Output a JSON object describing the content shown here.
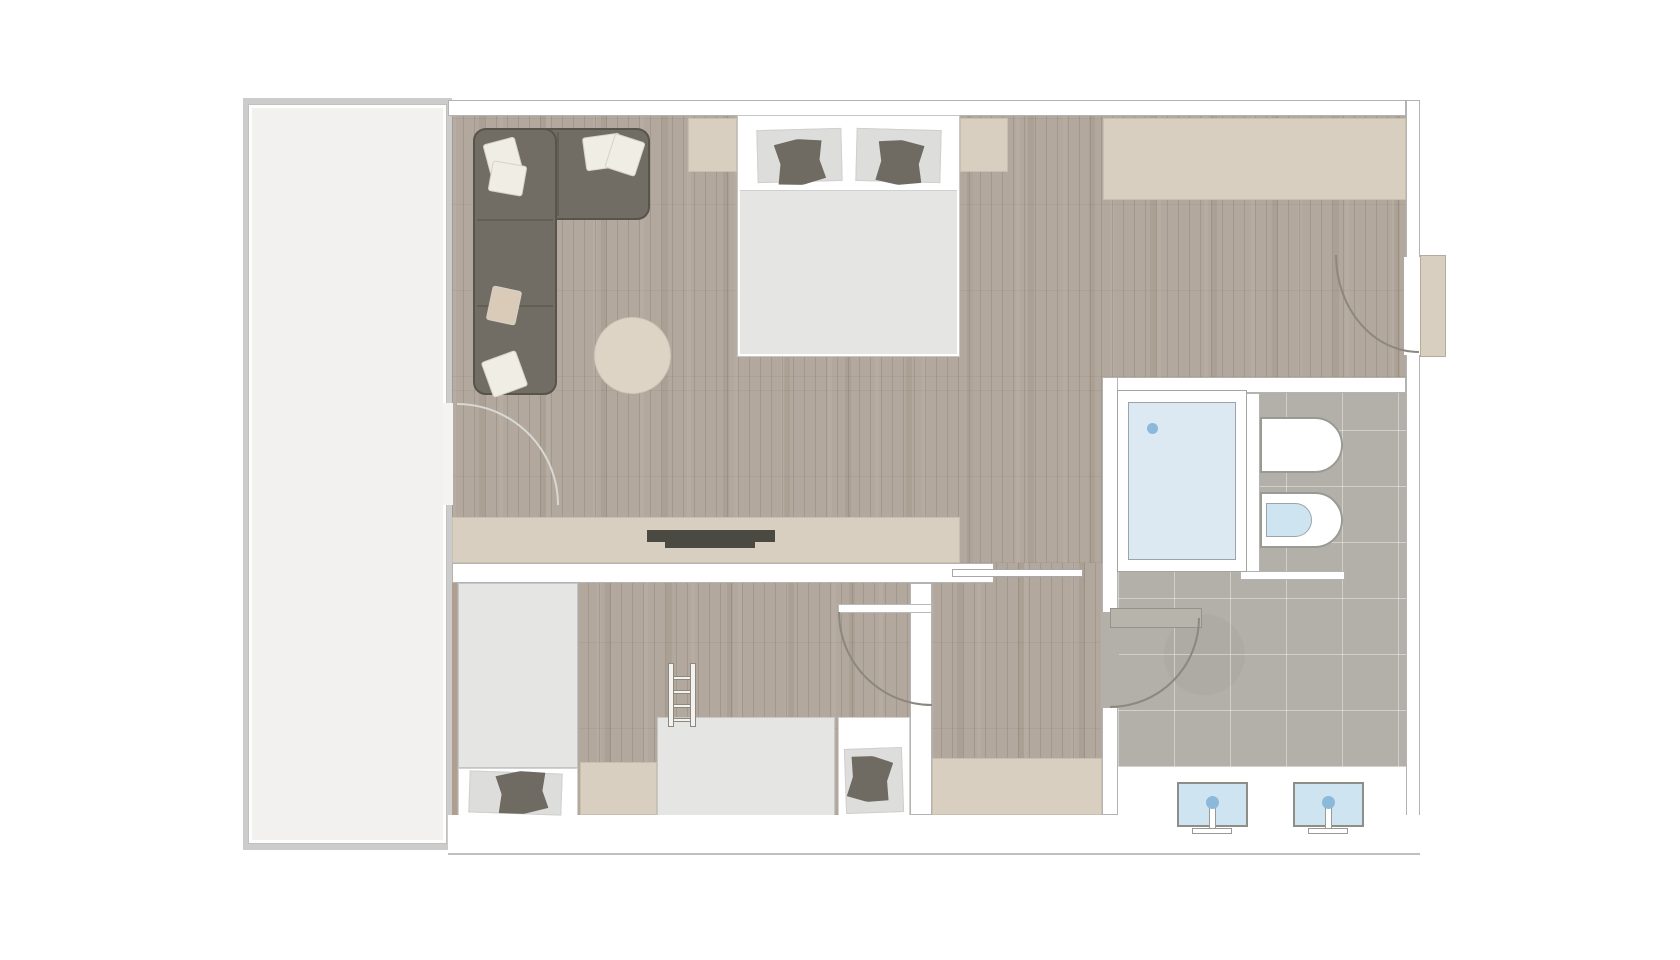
{
  "palette": {
    "background": "#ffffff",
    "wall_fill": "#ffffff",
    "wall_line": "#b3b3b3",
    "arc_line": "#8d887f",
    "arc_light": "#d8d8d4",
    "wood": "#b2a89d",
    "tile": "#b2b0a8",
    "balcony_band": "#cccccc",
    "balcony_floor": "#f2f1ef",
    "furniture_beige": "#d9cfc0",
    "furniture_beige_line": "#c9bfae",
    "sofa": "#716d65",
    "sofa_line": "#57544c",
    "cushion_dark": "#6f6b63",
    "pillow_light": "#dddddb",
    "pillow_white": "#f0ede5",
    "pillow_beige": "#d9cbb8",
    "duvet_gray": "#e5e5e3",
    "bed_white": "#ffffff",
    "ottoman": "#ded4c5",
    "tv_dark": "#4b4a42",
    "water_light": "#dce8f2",
    "water_mid": "#cfe4f1",
    "water_dot": "#8cb9da",
    "fixture_line": "#9a9a94",
    "door_leaf_gray": "#b7b4ab"
  },
  "floor_plan": {
    "type": "apartment-hotel-suite-top-view",
    "rooms": [
      {
        "id": "living-bedroom",
        "floor": "wood",
        "furniture": [
          "corner-sofa",
          "sofa-cushions",
          "ottoman",
          "double-bed",
          "bed-pillows",
          "nightstand-left",
          "nightstand-right",
          "wardrobe",
          "tv-sideboard",
          "tv"
        ]
      },
      {
        "id": "kids-room",
        "floor": "wood",
        "furniture": [
          "kids-bed-left",
          "bunk-bed",
          "bunk-ladder",
          "kids-bed-right"
        ]
      },
      {
        "id": "hallway",
        "floor": "wood",
        "furniture": [
          "hall-closet"
        ]
      },
      {
        "id": "bathroom",
        "floor": "tile",
        "fixtures": [
          "bathtub",
          "tub-drain",
          "toilet",
          "bidet",
          "sink-left",
          "sink-right",
          "faucet-left",
          "faucet-right",
          "vanity-counter"
        ]
      },
      {
        "id": "balcony",
        "floor": "screed"
      }
    ],
    "doors": [
      "entrance-door",
      "balcony-door",
      "kids-room-door",
      "bathroom-door",
      "sliding-door"
    ]
  }
}
